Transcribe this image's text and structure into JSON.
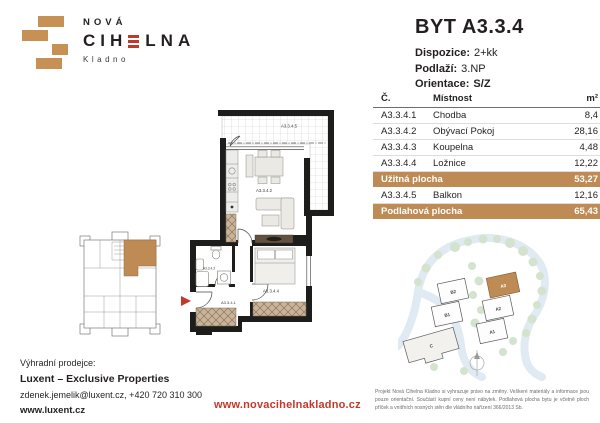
{
  "logo": {
    "brand_top": "NOVÁ",
    "brand_left": "CIH",
    "brand_right": "LNA",
    "city": "Kladno"
  },
  "header": {
    "title": "BYT A3.3.4",
    "specs": [
      {
        "label": "Dispozice:",
        "value": "2+kk"
      },
      {
        "label": "Podlaží:",
        "value": "3.NP"
      },
      {
        "label": "Orientace:",
        "value": "S/Z"
      }
    ]
  },
  "table": {
    "headers": {
      "num": "Č.",
      "room": "Místnost",
      "area": "m²"
    },
    "rows": [
      {
        "num": "A3.3.4.1",
        "room": "Chodba",
        "area": "8,4"
      },
      {
        "num": "A3.3.4.2",
        "room": "Obývací Pokoj",
        "area": "28,16"
      },
      {
        "num": "A3.3.4.3",
        "room": "Koupelna",
        "area": "4,48"
      },
      {
        "num": "A3.3.4.4",
        "room": "Ložnice",
        "area": "12,22"
      }
    ],
    "usable": {
      "label": "Užitná plocha",
      "value": "53,27"
    },
    "balcony_row": {
      "num": "A3.3.4.5",
      "room": "Balkon",
      "area": "12,16"
    },
    "total": {
      "label": "Podlahová plocha",
      "value": "65,43"
    }
  },
  "floorplan": {
    "balcony": "A3.3.4.5",
    "living": "A3.3.4.2",
    "bath": "A3.3.4.3",
    "hall": "A3.3.4.1",
    "bedroom": "A3.3.4.4"
  },
  "siteplan": {
    "b2": "B2",
    "b1": "B1",
    "a3": "A3",
    "a2": "A2",
    "a1": "A1",
    "c": "C"
  },
  "footer": {
    "seller_label": "Výhradní prodejce:",
    "seller_name": "Luxent – Exclusive Properties",
    "contact": "zdenek.jemelik@luxent.cz, +420 720 310 300",
    "seller_web": "www.luxent.cz",
    "project_web": "www.novacihelnakladno.cz",
    "disclaimer": "Projekt Nová Cihelna Kladno si vyhrazuje právo na změny. Veškeré materiály a informace jsou pouze orientační. Součástí kupní ceny není nábytek. Podlahová plocha bytu je včetně ploch příček a vnitřních nosných stěn dle vládního nařízení 366/2013 Sb."
  },
  "colors": {
    "brick": "#be8b55",
    "red": "#c03a2b"
  }
}
